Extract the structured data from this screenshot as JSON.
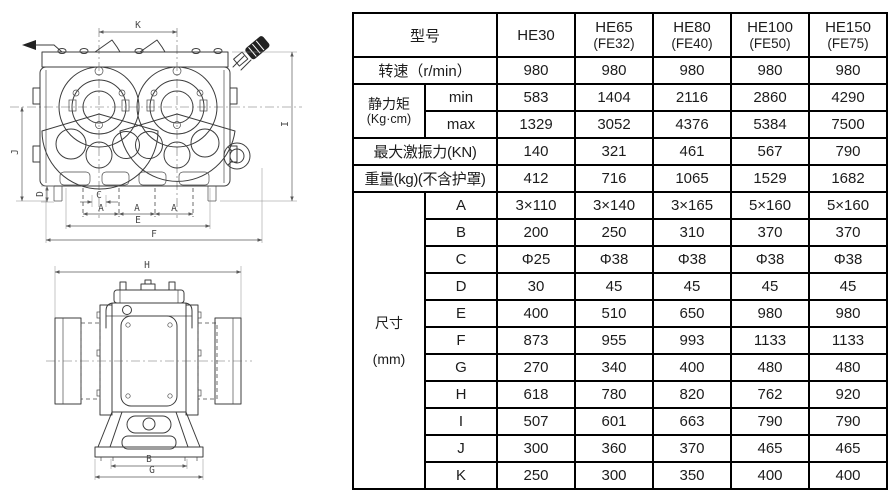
{
  "colors": {
    "header_blue": "#c9e2f4",
    "header_yellow": "#f7dc7a",
    "letter_cream": "#fbf2d8",
    "table_border": "#000000",
    "drawing_line": "#3c3c3c"
  },
  "drawing": {
    "front_view": {
      "dim_labels": {
        "K": "K",
        "I": "I",
        "J": "J",
        "D": "D",
        "C": "C",
        "A1": "A",
        "A2": "A",
        "A3": "A",
        "E": "E",
        "F": "F"
      }
    },
    "side_view": {
      "dim_labels": {
        "H": "H",
        "B": "B",
        "G": "G"
      }
    }
  },
  "table": {
    "model_row": {
      "label": "型号",
      "models": [
        {
          "name": "HE30",
          "sub": ""
        },
        {
          "name": "HE65",
          "sub": "(FE32)"
        },
        {
          "name": "HE80",
          "sub": "(FE40)"
        },
        {
          "name": "HE100",
          "sub": "(FE50)"
        },
        {
          "name": "HE150",
          "sub": "(FE75)"
        }
      ]
    },
    "speed": {
      "label": "转速（r/min）",
      "values": [
        "980",
        "980",
        "980",
        "980",
        "980"
      ]
    },
    "static_moment": {
      "label": "静力矩",
      "unit": "(Kg·cm)",
      "min_label": "min",
      "min_values": [
        "583",
        "1404",
        "2116",
        "2860",
        "4290"
      ],
      "max_label": "max",
      "max_values": [
        "1329",
        "3052",
        "4376",
        "5384",
        "7500"
      ]
    },
    "max_excitation": {
      "label": "最大激振力(KN)",
      "values": [
        "140",
        "321",
        "461",
        "567",
        "790"
      ]
    },
    "weight": {
      "label": "重量(kg)(不含护罩)",
      "values": [
        "412",
        "716",
        "1065",
        "1529",
        "1682"
      ]
    },
    "dimensions": {
      "label": "尺寸",
      "unit": "(mm)",
      "rows": [
        {
          "key": "A",
          "values": [
            "3×110",
            "3×140",
            "3×165",
            "5×160",
            "5×160"
          ]
        },
        {
          "key": "B",
          "values": [
            "200",
            "250",
            "310",
            "370",
            "370"
          ]
        },
        {
          "key": "C",
          "values": [
            "Φ25",
            "Φ38",
            "Φ38",
            "Φ38",
            "Φ38"
          ]
        },
        {
          "key": "D",
          "values": [
            "30",
            "45",
            "45",
            "45",
            "45"
          ]
        },
        {
          "key": "E",
          "values": [
            "400",
            "510",
            "650",
            "980",
            "980"
          ]
        },
        {
          "key": "F",
          "values": [
            "873",
            "955",
            "993",
            "1133",
            "1133"
          ]
        },
        {
          "key": "G",
          "values": [
            "270",
            "340",
            "400",
            "480",
            "480"
          ]
        },
        {
          "key": "H",
          "values": [
            "618",
            "780",
            "820",
            "762",
            "920"
          ]
        },
        {
          "key": "I",
          "values": [
            "507",
            "601",
            "663",
            "790",
            "790"
          ]
        },
        {
          "key": "J",
          "values": [
            "300",
            "360",
            "370",
            "465",
            "465"
          ]
        },
        {
          "key": "K",
          "values": [
            "250",
            "300",
            "350",
            "400",
            "400"
          ]
        }
      ]
    }
  }
}
